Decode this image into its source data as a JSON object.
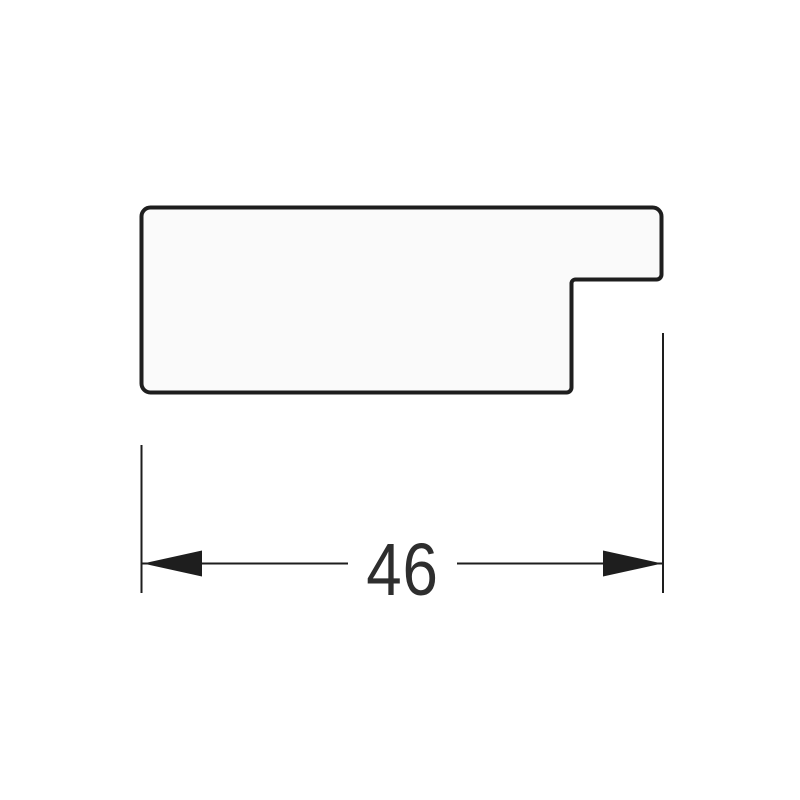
{
  "page": {
    "background_color": "#ffffff"
  },
  "drawing": {
    "profile": {
      "fill_color": "#fafafa",
      "outline_color": "#1e1e1e"
    },
    "dimension": {
      "value": "46",
      "line_color": "#1e1e1e",
      "text_color": "#2e2e2e"
    },
    "icons": {
      "left_arrowhead": "◀",
      "right_arrowhead": "▶"
    }
  }
}
